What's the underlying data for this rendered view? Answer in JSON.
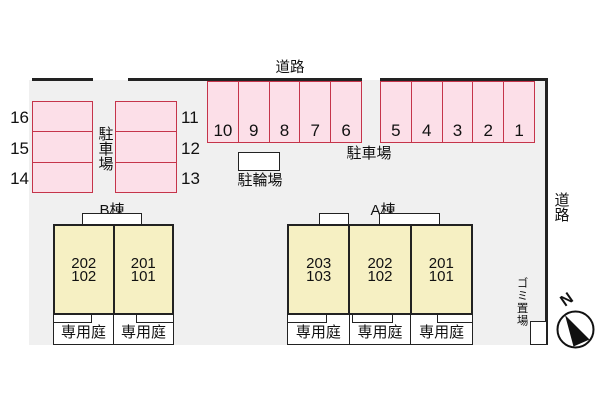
{
  "roads": {
    "top": "道路",
    "right": "道路"
  },
  "parking": {
    "lot_label_top": "駐車場",
    "lot_label_left": "駐車場",
    "bicycle_label": "駐輪場",
    "top_west": [
      "10",
      "9",
      "8",
      "7",
      "6"
    ],
    "top_east": [
      "5",
      "4",
      "3",
      "2",
      "1"
    ],
    "left_west": [
      "16",
      "15",
      "14"
    ],
    "left_east": [
      "11",
      "12",
      "13"
    ]
  },
  "buildings": {
    "b": {
      "name": "B棟",
      "garden_label": "専用庭",
      "units": [
        {
          "upper": "202",
          "lower": "102"
        },
        {
          "upper": "201",
          "lower": "101"
        }
      ]
    },
    "a": {
      "name": "A棟",
      "garden_label": "専用庭",
      "units": [
        {
          "upper": "203",
          "lower": "103"
        },
        {
          "upper": "202",
          "lower": "102"
        },
        {
          "upper": "201",
          "lower": "101"
        }
      ]
    }
  },
  "garbage_label": "ゴミ置場",
  "compass": {
    "n": "N"
  },
  "colors": {
    "c-pink": "#fcdfe8",
    "c-red": "#c5344a",
    "c-yellow": "#f6f0c3",
    "c-gray": "#f0f0f0",
    "c-line": "#222222",
    "c-text": "#111111",
    "c-white": "#ffffff"
  }
}
